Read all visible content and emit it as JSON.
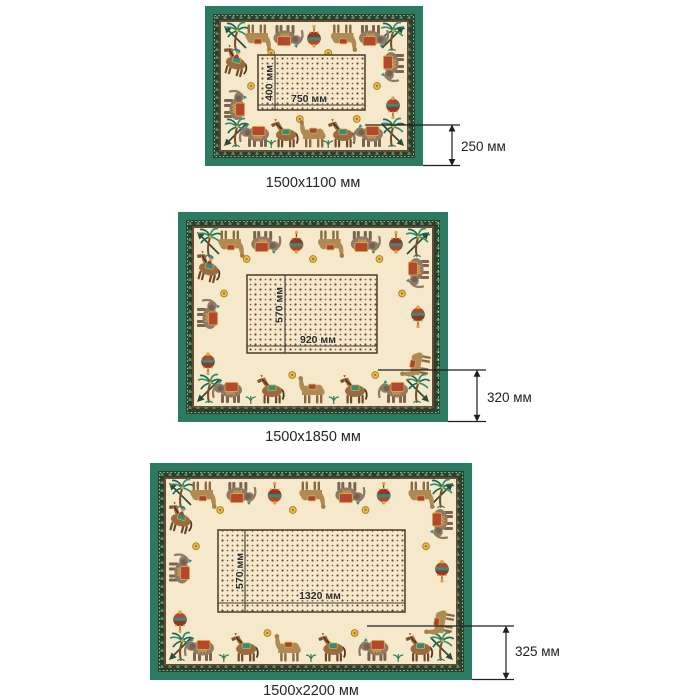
{
  "page": {
    "background": "#ffffff",
    "description_units": "мм"
  },
  "palette": {
    "frame_green": "#2b7a62",
    "band_dark": "#27422f",
    "band_motif": "#5d8a5f",
    "cream_field": "#f6e9cb",
    "accent_red": "#b3472f",
    "gold": "#d9a441",
    "teal": "#2e8f7a",
    "dimension_ink": "#1f1f1f"
  },
  "ornament_motifs": [
    "palm-tree",
    "elephant",
    "camel",
    "horse",
    "horse-rider",
    "ornament-bundle",
    "gold-sun",
    "spear",
    "sprig"
  ],
  "cloths": [
    {
      "size_label": "1500x1100 мм",
      "table_width": "750 мм",
      "table_height": "400 мм",
      "drop": "250 мм"
    },
    {
      "size_label": "1500x1850 мм",
      "table_width": "920 мм",
      "table_height": "570 мм",
      "drop": "320 мм"
    },
    {
      "size_label": "1500x2200 мм",
      "table_width": "1320 мм",
      "table_height": "570 мм",
      "drop": "325 мм"
    }
  ]
}
